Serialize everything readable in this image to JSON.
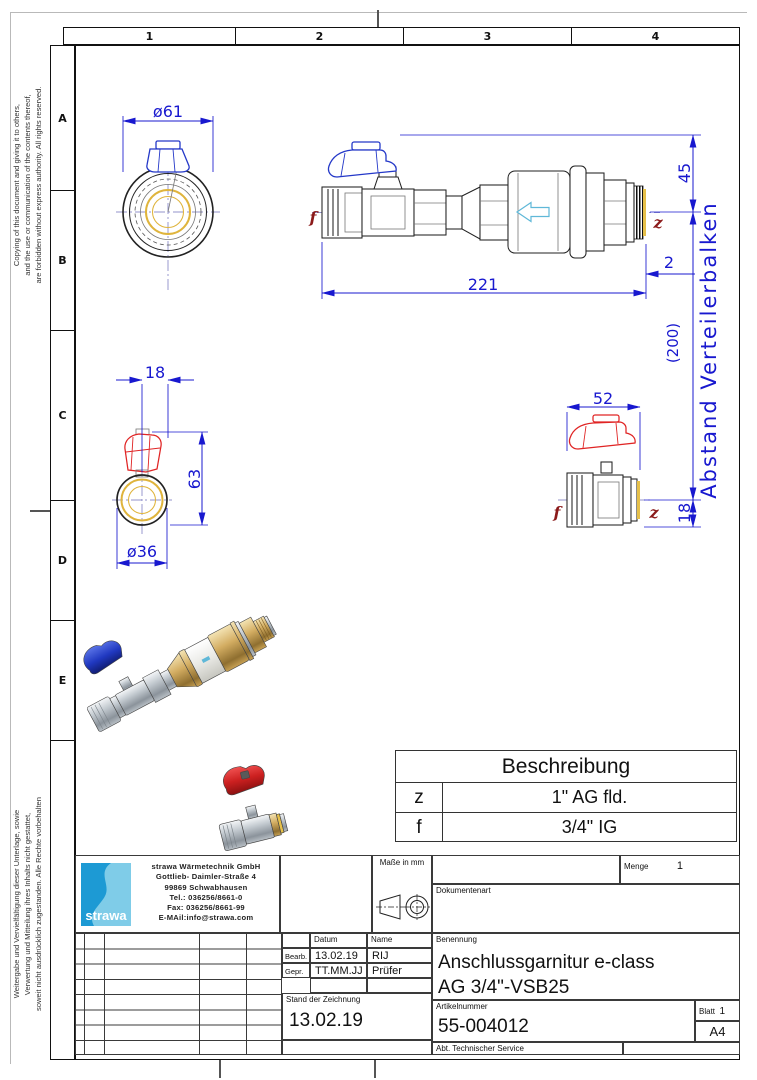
{
  "frame": {
    "columns": [
      "1",
      "2",
      "3",
      "4"
    ],
    "rows": [
      "A",
      "B",
      "C",
      "D",
      "E"
    ]
  },
  "margin_notes": {
    "top": "Copying of this document and giving it to others,\nand the use or communication of the contents thereof,\nare forbidden without express authority. All rights reserved.",
    "bottom": "Weitergabe und Vervielfältigung dieser Unterlage, sowie\nVerwertung und Mitteilung ihres Inhalts nicht gestattet,\nsoweit nicht ausdrücklich zugestanden. Alle Rechte vorbehalten"
  },
  "dimensions": {
    "front_diameter": "ø61",
    "side_length": "221",
    "side_height": "45",
    "side_thread_offset": "2",
    "axis_distance": "(200)",
    "axis_label": "Abstand Verteilerbalken",
    "axis_bottom": "18",
    "detail_left_top": "18",
    "detail_left_height": "63",
    "detail_left_diameter": "ø36",
    "detail_right_width": "52"
  },
  "ports": {
    "left": "f",
    "right": "z"
  },
  "description_table": {
    "title": "Beschreibung",
    "rows": [
      {
        "key": "z",
        "value": "1\" AG fld."
      },
      {
        "key": "f",
        "value": "3/4\" IG"
      }
    ]
  },
  "title_block": {
    "company": {
      "logo_text": "strawa",
      "name": "strawa Wärmetechnik GmbH",
      "address1": "Gottlieb- Daimler-Straße 4",
      "address2": "99869 Schwabhausen",
      "tel": "Tel.: 036256/8661-0",
      "fax": "Fax: 036256/8661-99",
      "email": "E-MAil:info@strawa.com"
    },
    "units_label": "Maße in mm",
    "menge_label": "Menge",
    "menge_value": "1",
    "dokumentenart_label": "Dokumentenart",
    "datum_label": "Datum",
    "name_label": "Name",
    "bearb_label": "Bearb.",
    "bearb_datum": "13.02.19",
    "bearb_name": "RIJ",
    "gepr_label": "Gepr.",
    "gepr_datum": "TT.MM.JJ",
    "gepr_name": "Prüfer",
    "benennung_label": "Benennung",
    "benennung_line1": "Anschlussgarnitur e-class",
    "benennung_line2": "AG 3/4\"-VSB25",
    "stand_label": "Stand der Zeichnung",
    "stand_value": "13.02.19",
    "artikelnummer_label": "Artikelnummer",
    "artikelnummer_value": "55-004012",
    "blatt_label": "Blatt",
    "blatt_value": "1",
    "format_value": "A4",
    "abteilung": "Abt. Technischer Service"
  },
  "colors": {
    "dimension_blue": "#1818cf",
    "port_dark_red": "#8b1a1a",
    "handle_red": "#e02424",
    "handle_blue": "#2438c8",
    "brass_yellow": "#e6c04a",
    "logo_blue": "#1d9ad4"
  }
}
